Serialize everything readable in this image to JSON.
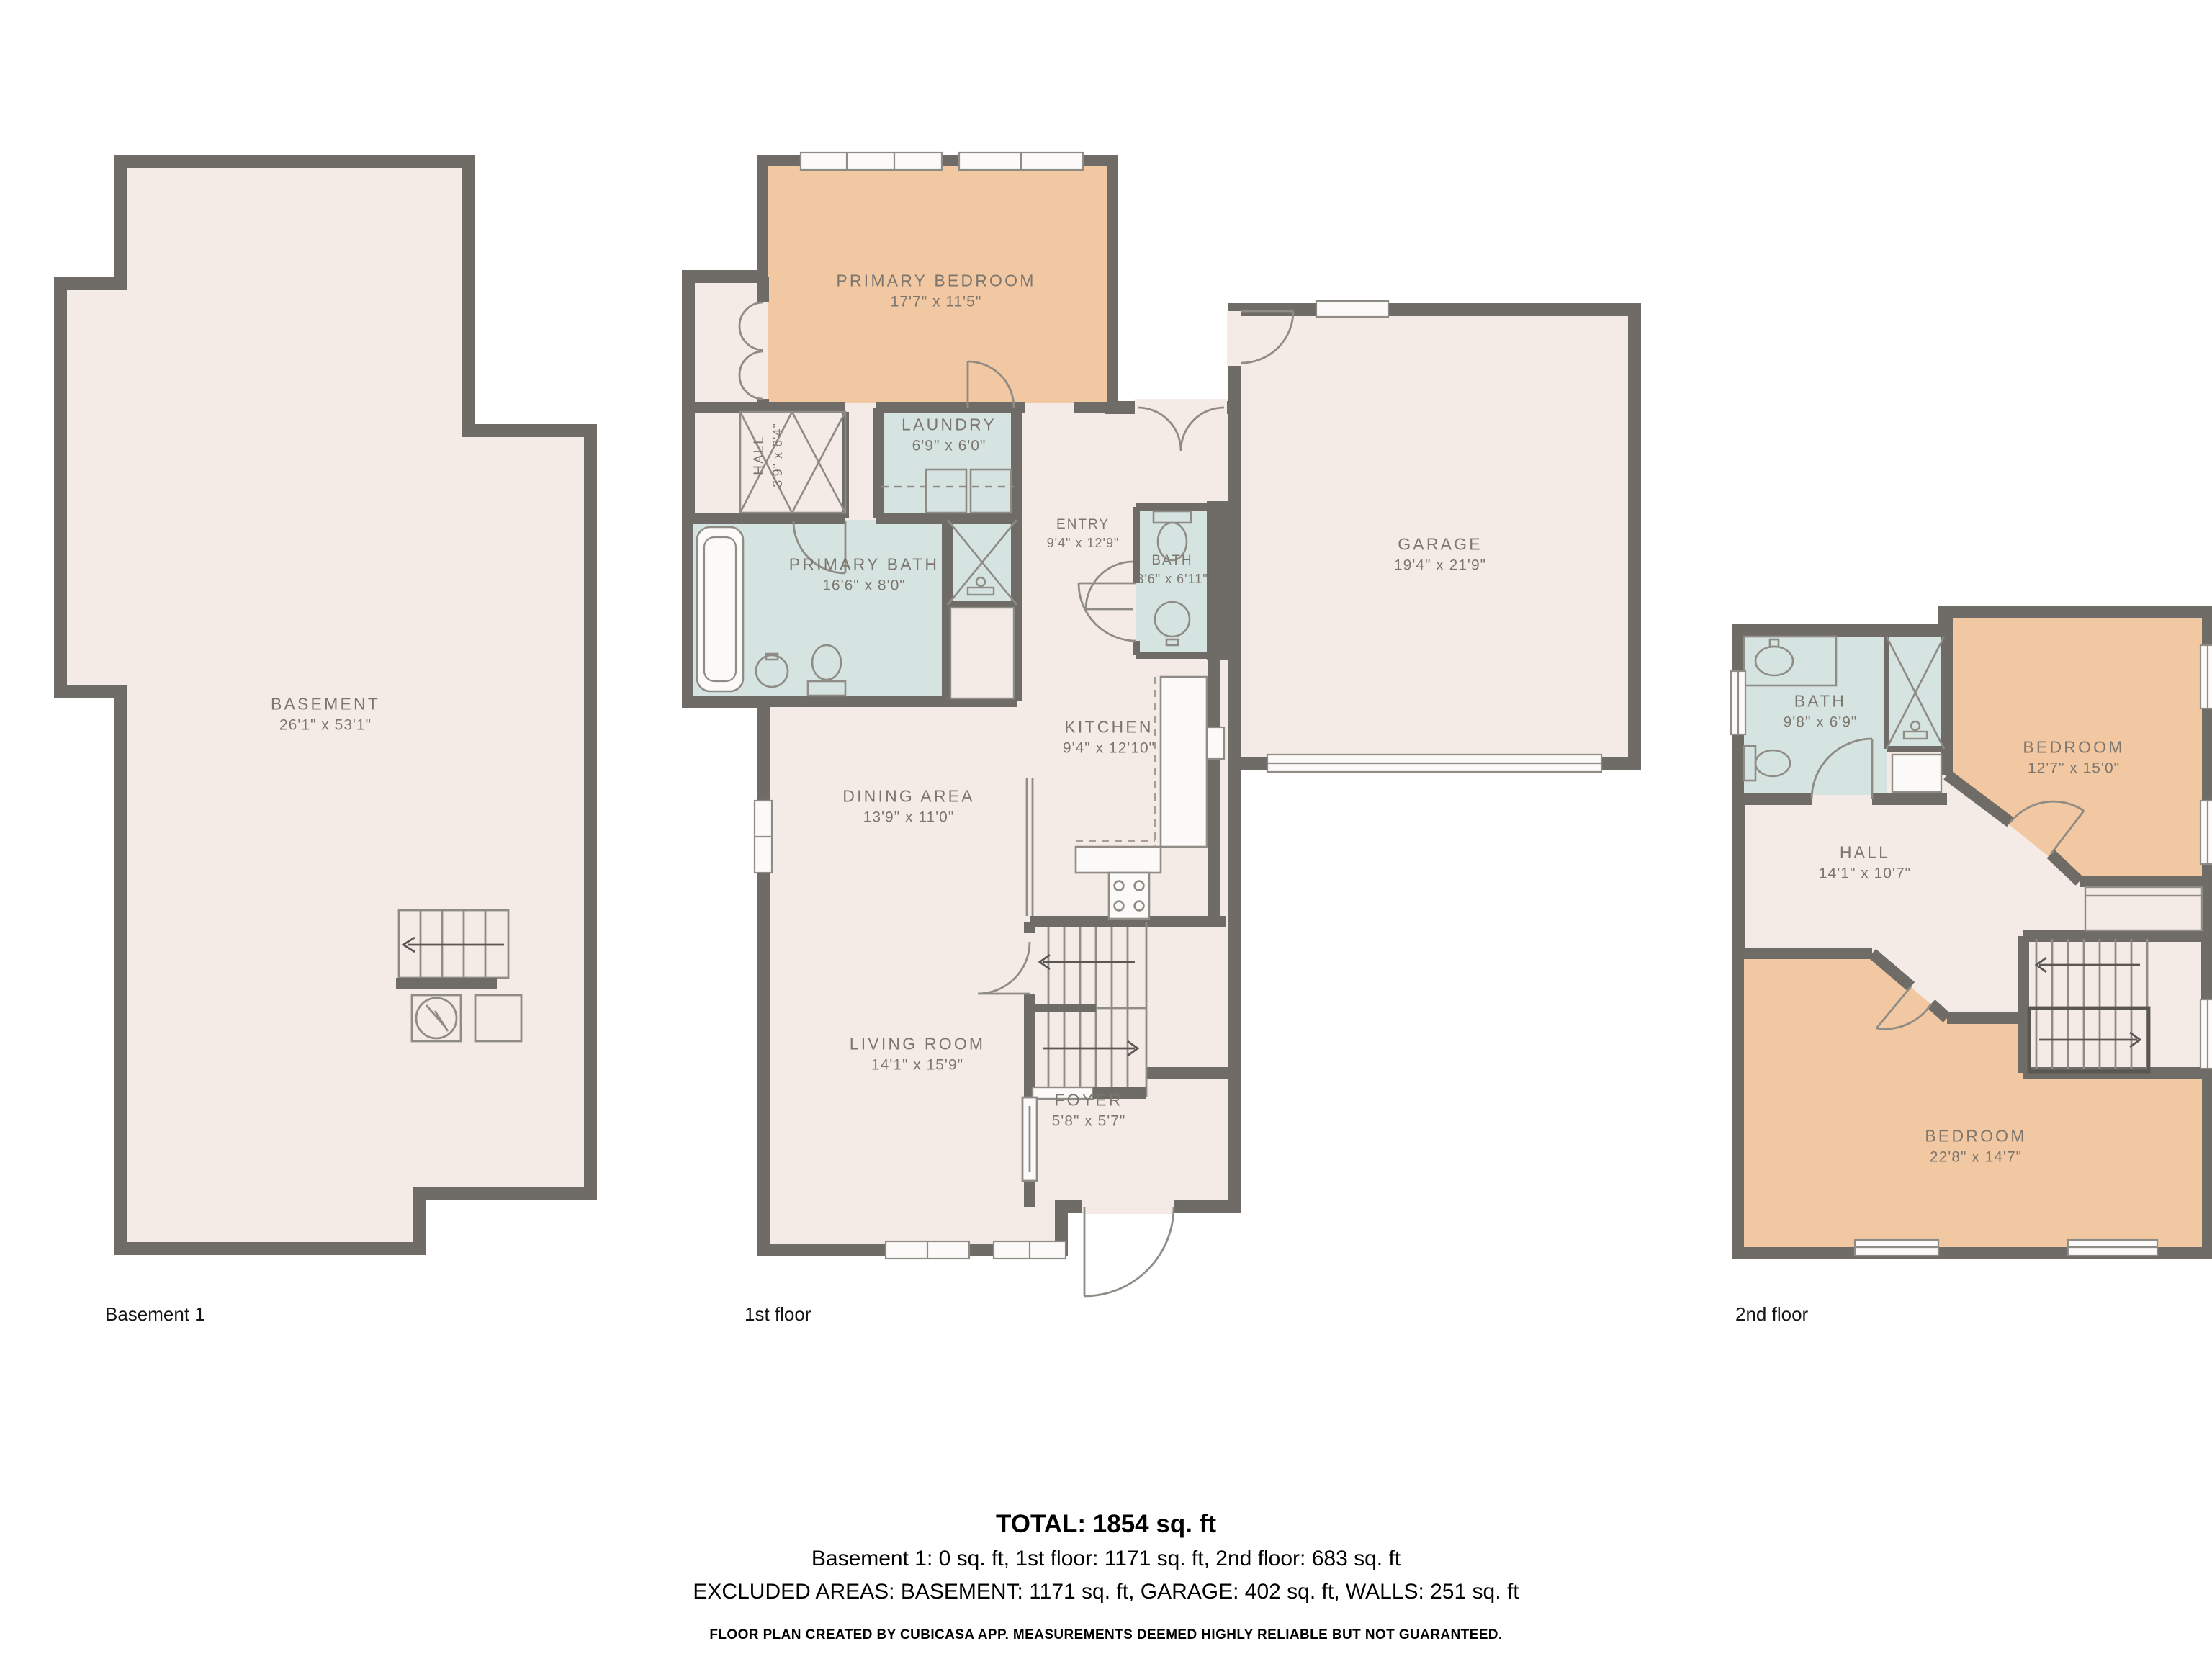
{
  "colors": {
    "wall": "#6f6b67",
    "floor": "#f5ebe6",
    "bedroom": "#f1c8a2",
    "wet_room": "#d6e4e1",
    "fixture_stroke": "#8f8b85",
    "label_text": "#7c766f"
  },
  "floors": [
    {
      "floor_label": "Basement 1",
      "rooms": [
        {
          "name": "BASEMENT",
          "dims": "26'1\" x 53'1\""
        }
      ]
    },
    {
      "floor_label": "1st floor",
      "rooms": [
        {
          "name": "PRIMARY BEDROOM",
          "dims": "17'7\" x 11'5\""
        },
        {
          "name": "HALL",
          "dims": "3'9\" x 6'4\""
        },
        {
          "name": "LAUNDRY",
          "dims": "6'9\" x 6'0\""
        },
        {
          "name": "ENTRY",
          "dims": "9'4\" x 12'9\""
        },
        {
          "name": "PRIMARY BATH",
          "dims": "16'6\" x 8'0\""
        },
        {
          "name": "BATH",
          "dims": "3'6\" x 6'11\""
        },
        {
          "name": "GARAGE",
          "dims": "19'4\" x 21'9\""
        },
        {
          "name": "KITCHEN",
          "dims": "9'4\" x 12'10\""
        },
        {
          "name": "DINING AREA",
          "dims": "13'9\" x 11'0\""
        },
        {
          "name": "LIVING ROOM",
          "dims": "14'1\" x 15'9\""
        },
        {
          "name": "FOYER",
          "dims": "5'8\" x 5'7\""
        }
      ]
    },
    {
      "floor_label": "2nd floor",
      "rooms": [
        {
          "name": "BATH",
          "dims": "9'8\" x 6'9\""
        },
        {
          "name": "BEDROOM",
          "dims": "12'7\" x 15'0\""
        },
        {
          "name": "HALL",
          "dims": "14'1\" x 10'7\""
        },
        {
          "name": "BEDROOM",
          "dims": "22'8\" x 14'7\""
        }
      ]
    }
  ],
  "summary": {
    "total": "TOTAL: 1854 sq. ft",
    "floors_line": "Basement 1: 0 sq. ft, 1st floor: 1171 sq. ft, 2nd floor: 683 sq. ft",
    "excluded_line": "EXCLUDED AREAS: BASEMENT: 1171 sq. ft, GARAGE: 402 sq. ft, WALLS: 251 sq. ft",
    "disclaimer": "FLOOR PLAN CREATED BY CUBICASA APP. MEASUREMENTS DEEMED HIGHLY RELIABLE BUT NOT GUARANTEED."
  }
}
